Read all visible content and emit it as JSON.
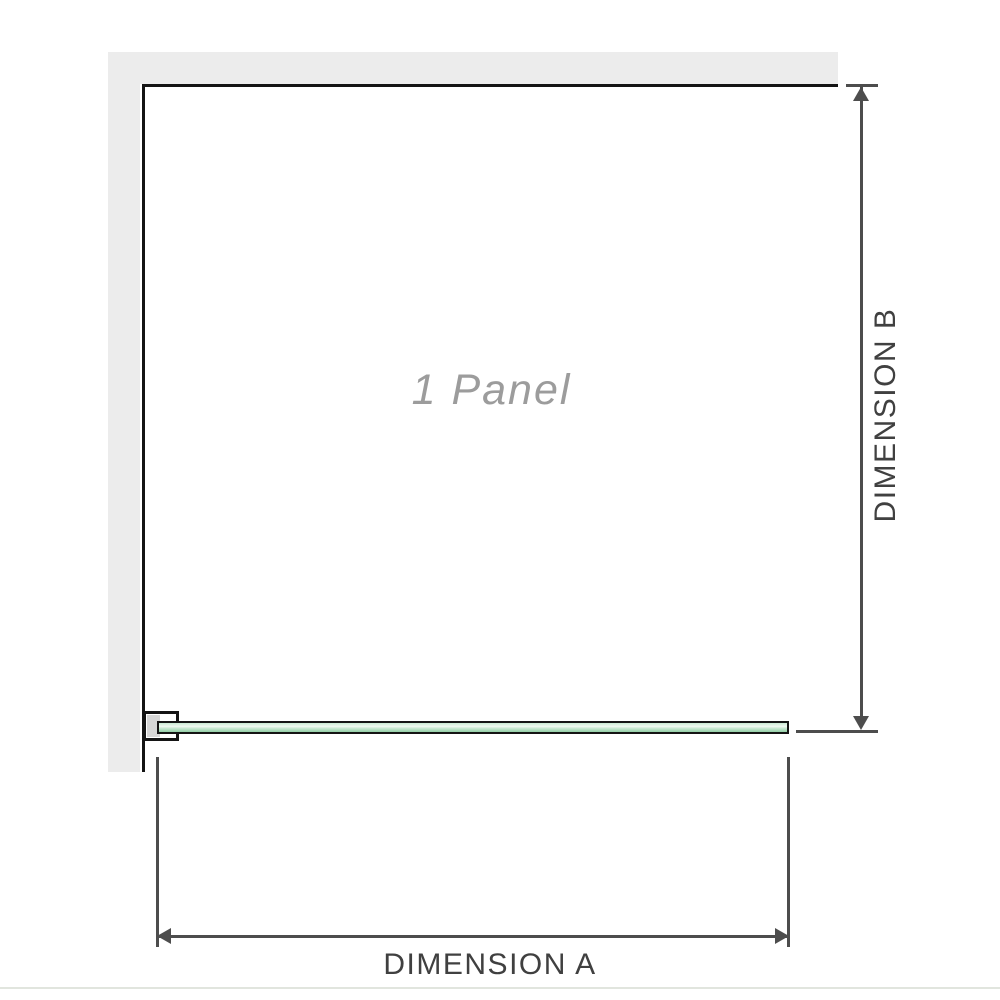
{
  "diagram": {
    "panel_label": "1 Panel",
    "dim_a_label": "DIMENSION A",
    "dim_b_label": "DIMENSION B"
  },
  "colors": {
    "wall": "#ececec",
    "outline": "#141414",
    "dimension": "#4d4d4d",
    "dim_text": "#404040",
    "label_text": "#9c9c9c",
    "bracket_fill": "#d6d6d6",
    "glass_top": "#c9e8d2",
    "glass_highlight": "#f0f9f1",
    "glass_bottom": "#93cfa6",
    "separator": "#e1e5de"
  }
}
